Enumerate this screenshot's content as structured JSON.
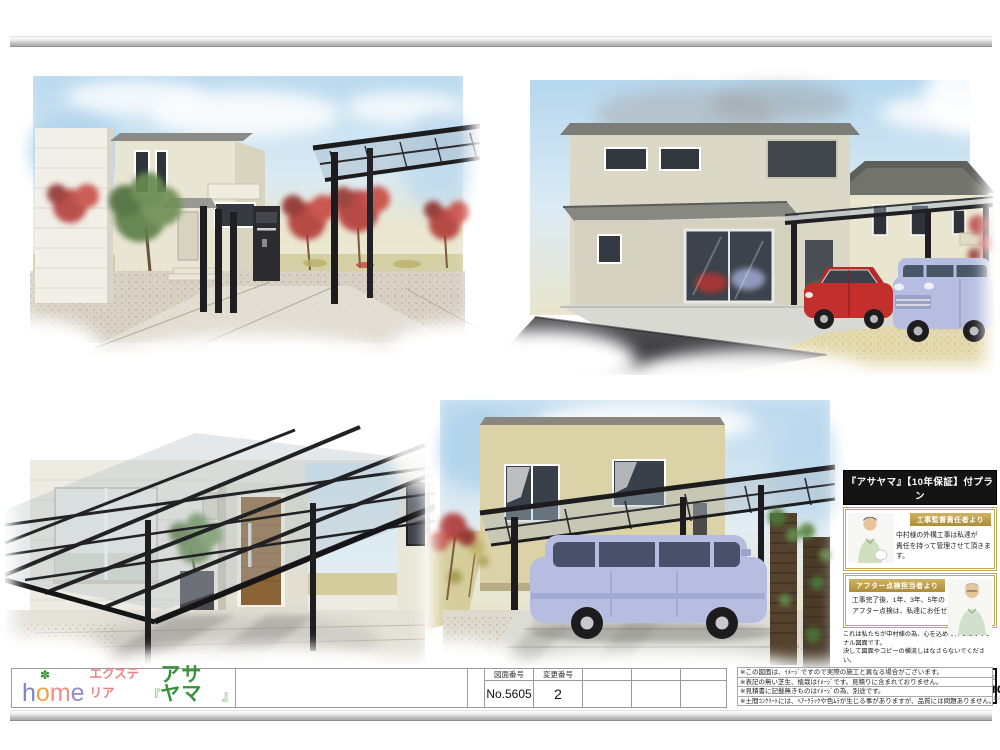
{
  "palette": {
    "brand_green": "#37903a",
    "logo_pink": "#ee8383",
    "badge_gold": "#b8954a",
    "header_black": "#141414",
    "frame_black": "#1e1e22",
    "car_red": "#c22f2c",
    "car_lavender": "#b6bde0"
  },
  "sidebar": {
    "title": "『アサヤマ』【10年保証】付プラン",
    "supervisor": {
      "badge": "工事監督責任者より",
      "message": "中村様の外構工事は私達が\n責任を持って管理させて頂きます。"
    },
    "aftercare": {
      "badge": "アフター点検担当者より",
      "message": "工事完了後、1年、3年、5年の\nアフター点検は、私達にお任せ下さい。"
    },
    "original_notice": "これは私たちが中村様の為、心を込めて作ったオリジナル図面です。\n決して図面やコピーの横流しはなさらないでください。",
    "moral": {
      "statement": "他社の図面を利用した受注行為は致しません。",
      "slogan": "New moral standard",
      "fine_print": "私たちはエクステリアのトータルプランナーとして高い倫理基準を持って取り組んでいます。"
    }
  },
  "logo": {
    "clover": "✽",
    "home_letters": [
      {
        "ch": "h",
        "color": "#7b85c9"
      },
      {
        "ch": "o",
        "color": "#f2a43e"
      },
      {
        "ch": "m",
        "color": "#f08d8d"
      },
      {
        "ch": "e",
        "color": "#948bd0"
      }
    ],
    "exterior": "エクステリア",
    "quote_open": "『",
    "brand": "アサヤマ",
    "quote_close": "』"
  },
  "titleblock": {
    "drawing_no_label": "図面番号",
    "drawing_no_value": "No.5605",
    "change_no_label": "変更番号",
    "change_no_value": "2"
  },
  "notes": [
    "※この図面は、ｲﾒｰｼﾞですので実際の施工と異なる場合がございます。",
    "※表記の無い芝生、植栽はｲﾒｰｼﾞです。見積りに含まれておりません。",
    "※見積書に記載無きものはｲﾒｰｼﾞの為、別途です。",
    "※土間ｺﾝｸﾘｰﾄには、ﾍｱｰｸﾗｯｸや色ﾑﾗが生じる事がありますが、品質には問題ありません。"
  ]
}
